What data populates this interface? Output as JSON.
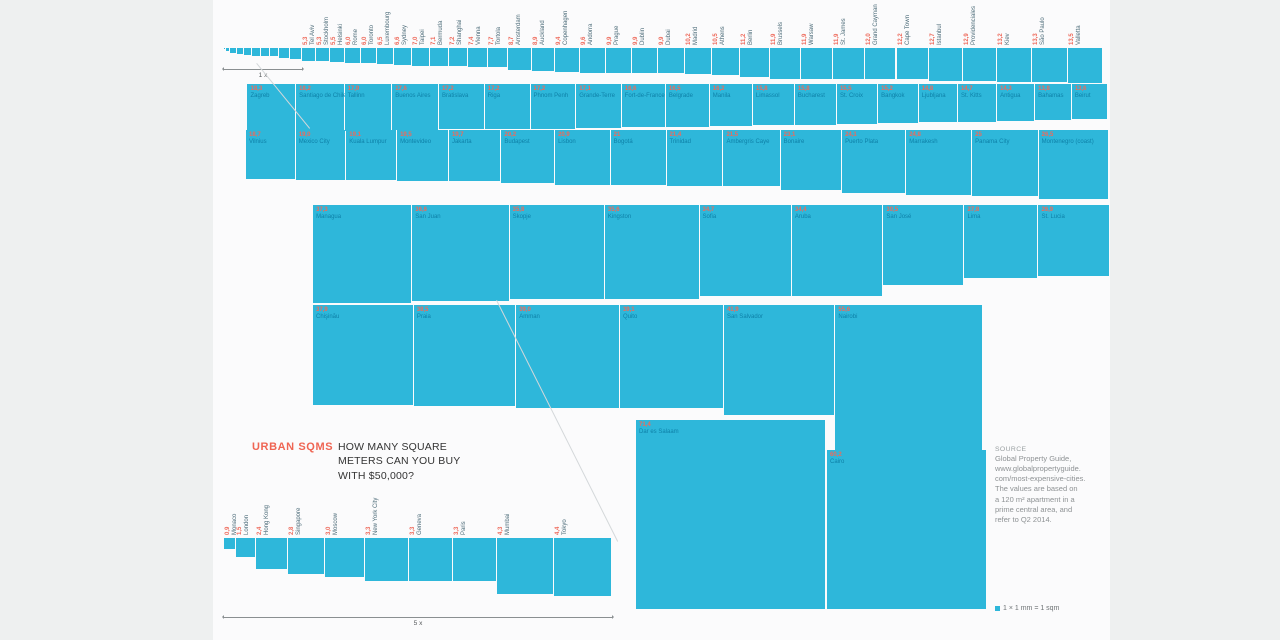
{
  "title": {
    "brand": "URBAN SQMS",
    "question": "HOW MANY SQUARE\nMETERS CAN YOU BUY\nWITH $50,000?"
  },
  "source": {
    "heading": "SOURCE",
    "text": "Global Property Guide,\nwww.globalpropertyguide.\ncom/most-expensive-cities.\nThe values are based on\na 120 m² apartment in a\nprime central area, and\nrefer to Q2 2014."
  },
  "legend": {
    "swatch_color": "#2eb7da",
    "label": "1 × 1 mm = 1 sqm"
  },
  "colors": {
    "square": "#2eb7da",
    "value_text": "#ee6a5b",
    "city_text_on_square": "#0e81a8",
    "city_text_rotated": "#4d6c79",
    "brand_text": "#ef6553",
    "page_panel": "#fbfbfc",
    "outer_background": "#eef0f0"
  },
  "chart_data": {
    "type": "bar",
    "title": "URBAN SQMS — HOW MANY SQUARE METERS CAN YOU BUY WITH $50,000?",
    "unit": "square meters per $50,000",
    "scale_note": "1 × 1 mm = 1 sqm",
    "px_per_sqm": 2.66,
    "reference_cities": [
      {
        "name": "Monaco",
        "value": 0.9,
        "label": "0,9"
      },
      {
        "name": "London",
        "value": 1.5,
        "label": "1,5"
      },
      {
        "name": "Hong Kong",
        "value": 2.4,
        "label": "2,4"
      },
      {
        "name": "Singapore",
        "value": 2.8,
        "label": "2,8"
      },
      {
        "name": "Moscow",
        "value": 3.0,
        "label": "3,0"
      },
      {
        "name": "New York City",
        "value": 3.3,
        "label": "3,3"
      },
      {
        "name": "Geneva",
        "value": 3.3,
        "label": "3,3"
      },
      {
        "name": "Paris",
        "value": 3.3,
        "label": "3,3"
      },
      {
        "name": "Mumbai",
        "value": 4.3,
        "label": "4,3"
      },
      {
        "name": "Tokyo",
        "value": 4.4,
        "label": "4,4"
      }
    ],
    "groups": [
      {
        "id": "scale-1x-strip",
        "y": 48,
        "x": 224,
        "align": "left",
        "labels": "none",
        "scale": 1,
        "cities_ref": "reference_cities"
      },
      {
        "id": "row-1",
        "y": 48,
        "x": 302,
        "align": "left",
        "labels": "rotated",
        "scale": 1,
        "cities": [
          {
            "name": "Tel Aviv",
            "value": 5.3,
            "label": "5,3"
          },
          {
            "name": "Stockholm",
            "value": 5.3,
            "label": "5,3"
          },
          {
            "name": "Helsinki",
            "value": 5.5,
            "label": "5,5"
          },
          {
            "name": "Rome",
            "value": 6.0,
            "label": "6,0"
          },
          {
            "name": "Toronto",
            "value": 6.0,
            "label": "6,0"
          },
          {
            "name": "Luxembourg",
            "value": 6.5,
            "label": "6,5"
          },
          {
            "name": "Sydney",
            "value": 6.6,
            "label": "6,6"
          },
          {
            "name": "Taipei",
            "value": 7.0,
            "label": "7,0"
          },
          {
            "name": "Bermuda",
            "value": 7.1,
            "label": "7,1"
          },
          {
            "name": "Shanghai",
            "value": 7.2,
            "label": "7,2"
          },
          {
            "name": "Vienna",
            "value": 7.4,
            "label": "7,4"
          },
          {
            "name": "Tortola",
            "value": 7.7,
            "label": "7,7"
          },
          {
            "name": "Amsterdam",
            "value": 8.7,
            "label": "8,7"
          },
          {
            "name": "Auckland",
            "value": 8.9,
            "label": "8,9"
          },
          {
            "name": "Copenhagen",
            "value": 9.4,
            "label": "9,4"
          },
          {
            "name": "Andorra",
            "value": 9.6,
            "label": "9,6"
          },
          {
            "name": "Prague",
            "value": 9.9,
            "label": "9,9"
          },
          {
            "name": "Dublin",
            "value": 9.9,
            "label": "9,9"
          },
          {
            "name": "Dubai",
            "value": 9.9,
            "label": "9,9"
          },
          {
            "name": "Madrid",
            "value": 10.2,
            "label": "10,2"
          },
          {
            "name": "Athens",
            "value": 10.5,
            "label": "10,5"
          },
          {
            "name": "Berlin",
            "value": 11.2,
            "label": "11,2"
          },
          {
            "name": "Brussels",
            "value": 11.9,
            "label": "11,9"
          },
          {
            "name": "Warsaw",
            "value": 11.9,
            "label": "11,9"
          },
          {
            "name": "St. James",
            "value": 11.9,
            "label": "11,9"
          },
          {
            "name": "Grand Cayman",
            "value": 12.0,
            "label": "12,0"
          },
          {
            "name": "Cape Town",
            "value": 12.2,
            "label": "12,2"
          },
          {
            "name": "Istanbul",
            "value": 12.7,
            "label": "12,7"
          },
          {
            "name": "Providenciales",
            "value": 12.9,
            "label": "12,9"
          },
          {
            "name": "Kiev",
            "value": 13.2,
            "label": "13,2"
          },
          {
            "name": "São Paulo",
            "value": 13.3,
            "label": "13,3"
          },
          {
            "name": "Valletta",
            "value": 13.5,
            "label": "13,5"
          }
        ]
      },
      {
        "id": "row-2",
        "y": 84,
        "x": 1108,
        "align": "right",
        "labels": "onsquare",
        "scale": 1,
        "cities": [
          {
            "name": "Zagreb",
            "value": 18.3,
            "label": "18,3"
          },
          {
            "name": "Santiago de Chile",
            "value": 18.2,
            "label": "18,2"
          },
          {
            "name": "Tallinn",
            "value": 17.9,
            "label": "17,9"
          },
          {
            "name": "Buenos Aires",
            "value": 17.6,
            "label": "17,6"
          },
          {
            "name": "Bratislava",
            "value": 17.2,
            "label": "17,2"
          },
          {
            "name": "Riga",
            "value": 17.2,
            "label": "17,2"
          },
          {
            "name": "Phnom Penh",
            "value": 17.2,
            "label": "17,2"
          },
          {
            "name": "Grande-Terre",
            "value": 17.1,
            "label": "17,1"
          },
          {
            "name": "Fort-de-France",
            "value": 16.6,
            "label": "16,6"
          },
          {
            "name": "Belgrade",
            "value": 16.5,
            "label": "16,5"
          },
          {
            "name": "Manila",
            "value": 16.2,
            "label": "16,2"
          },
          {
            "name": "Limassol",
            "value": 15.8,
            "label": "15,8"
          },
          {
            "name": "Bucharest",
            "value": 15.8,
            "label": "15,8"
          },
          {
            "name": "St. Croix",
            "value": 15.5,
            "label": "15,5"
          },
          {
            "name": "Bangkok",
            "value": 15.2,
            "label": "15,2"
          },
          {
            "name": "Ljubljana",
            "value": 14.8,
            "label": "14,8"
          },
          {
            "name": "St. Kitts",
            "value": 14.7,
            "label": "14,7"
          },
          {
            "name": "Antigua",
            "value": 14.3,
            "label": "14,3"
          },
          {
            "name": "Bahamas",
            "value": 13.8,
            "label": "13,8"
          },
          {
            "name": "Beirut",
            "value": 13.6,
            "label": "13,6"
          }
        ]
      },
      {
        "id": "row-3",
        "y": 130,
        "x": 246,
        "align": "left",
        "labels": "onsquare",
        "scale": 1,
        "cities": [
          {
            "name": "Vilnius",
            "value": 18.7,
            "label": "18,7"
          },
          {
            "name": "Mexico City",
            "value": 19.0,
            "label": "19,0"
          },
          {
            "name": "Kuala Lumpur",
            "value": 19.1,
            "label": "19,1"
          },
          {
            "name": "Montevideo",
            "value": 19.5,
            "label": "19,5"
          },
          {
            "name": "Jakarta",
            "value": 19.7,
            "label": "19,7"
          },
          {
            "name": "Budapest",
            "value": 20.2,
            "label": "20,2"
          },
          {
            "name": "Lisbon",
            "value": 20.9,
            "label": "20,9"
          },
          {
            "name": "Bogotá",
            "value": 21,
            "label": "21"
          },
          {
            "name": "Trinidad",
            "value": 21.4,
            "label": "21,4"
          },
          {
            "name": "Ambergris Caye",
            "value": 21.5,
            "label": "21,5"
          },
          {
            "name": "Bonaire",
            "value": 23.1,
            "label": "23,1"
          },
          {
            "name": "Puerto Plata",
            "value": 24.1,
            "label": "24,1"
          },
          {
            "name": "Marrakesh",
            "value": 24.8,
            "label": "24,8"
          },
          {
            "name": "Panama City",
            "value": 25,
            "label": "25"
          },
          {
            "name": "Montenegro (coast)",
            "value": 26.5,
            "label": "26,5"
          }
        ]
      },
      {
        "id": "row-4",
        "y": 205,
        "x": 1110,
        "align": "right",
        "labels": "onsquare",
        "scale": 1,
        "cities": [
          {
            "name": "Managua",
            "value": 37.3,
            "label": "37,3"
          },
          {
            "name": "San Juan",
            "value": 36.6,
            "label": "36,6"
          },
          {
            "name": "Skopje",
            "value": 35.8,
            "label": "35,8"
          },
          {
            "name": "Kingston",
            "value": 35.6,
            "label": "35,6"
          },
          {
            "name": "Sofia",
            "value": 34.7,
            "label": "34,7"
          },
          {
            "name": "Aruba",
            "value": 34.4,
            "label": "34,4"
          },
          {
            "name": "San José",
            "value": 30.5,
            "label": "30,5"
          },
          {
            "name": "Lima",
            "value": 27.8,
            "label": "27,8"
          },
          {
            "name": "St. Lucia",
            "value": 26.9,
            "label": "26,9"
          }
        ]
      },
      {
        "id": "row-5",
        "y": 305,
        "x": 313,
        "align": "left",
        "labels": "onsquare",
        "scale": 1,
        "cities": [
          {
            "name": "Chişinău",
            "value": 37.9,
            "label": "37,9"
          },
          {
            "name": "Praia",
            "value": 38.5,
            "label": "38,5"
          },
          {
            "name": "Amman",
            "value": 39.0,
            "label": "39,0"
          },
          {
            "name": "Quito",
            "value": 39.1,
            "label": "39,1"
          },
          {
            "name": "San Salvador",
            "value": 41.9,
            "label": "41,9"
          },
          {
            "name": "Nairobi",
            "value": 55.6,
            "label": "55,6"
          }
        ]
      },
      {
        "id": "scale-5x-group",
        "y": 538,
        "x": 224,
        "align": "left",
        "labels": "rotated",
        "scale": 5,
        "cities_ref": "reference_cities"
      }
    ],
    "singles": [
      {
        "name": "Dar es Salaam",
        "value": 71.4,
        "label": "71,4",
        "x": 636,
        "y": 420
      },
      {
        "name": "Cairo",
        "value": 60.2,
        "label": "60,2",
        "x": 827,
        "y": 450
      }
    ],
    "scale_markers": [
      {
        "label": "1 x",
        "x1": 224,
        "x2": 302,
        "y": 69
      },
      {
        "label": "5 x",
        "x1": 224,
        "x2": 612,
        "y": 617
      }
    ],
    "connector_lines": [
      {
        "x1": 257,
        "y1": 63,
        "x2": 310,
        "y2": 128
      },
      {
        "x1": 497,
        "y1": 300,
        "x2": 618,
        "y2": 541
      }
    ]
  }
}
